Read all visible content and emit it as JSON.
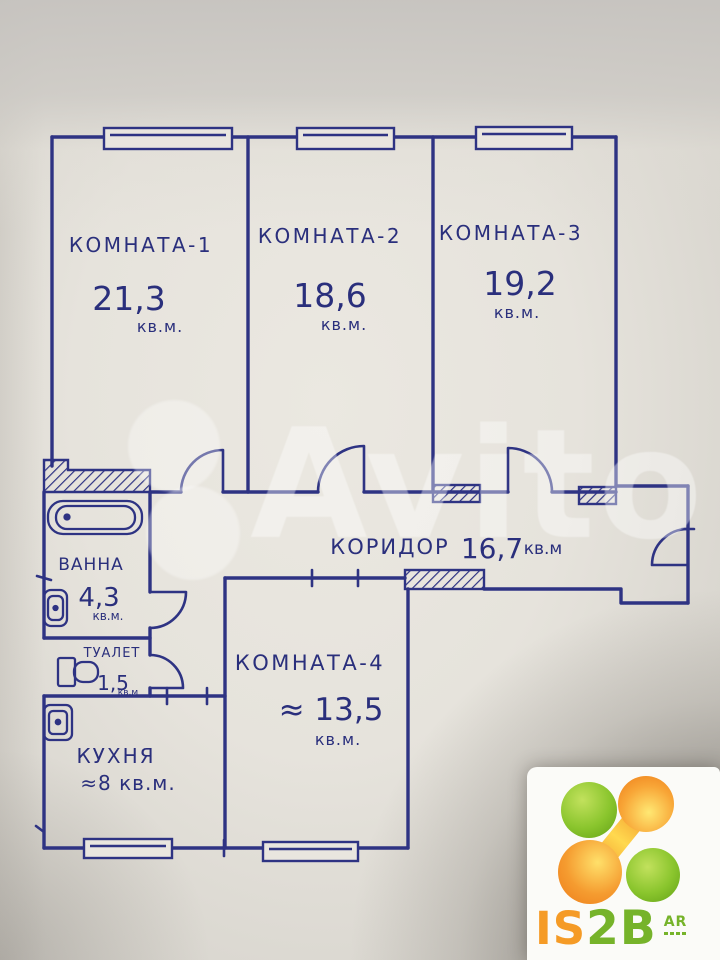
{
  "ink_color": "#2e3383",
  "paper_color": "#e7e4dd",
  "rooms": [
    {
      "name": "КОМНАТА-1",
      "area": "21,3",
      "unit": "кв.м."
    },
    {
      "name": "КОМНАТА-2",
      "area": "18,6",
      "unit": "кв.м."
    },
    {
      "name": "КОМНАТА-3",
      "area": "19,2",
      "unit": "кв.м."
    },
    {
      "name": "КОМНАТА-4",
      "area": "≈ 13,5",
      "unit": "кв.м."
    }
  ],
  "corridor": {
    "name": "КОРИДОР",
    "area": "16,7",
    "unit": "кв.м"
  },
  "bath": {
    "name": "ВАННА",
    "area": "4,3",
    "unit": "кв.м."
  },
  "toilet": {
    "name": "ТУАЛЕТ",
    "area": "1,5",
    "unit": "кв.м"
  },
  "kitchen": {
    "name": "КУХНЯ",
    "area": "≈8 кв.м."
  },
  "watermark": {
    "text": "Avito"
  },
  "logo": {
    "is": "IS",
    "twob": "2B",
    "badge": "AR",
    "green": "#76b32a",
    "orange": "#ef8a1e"
  }
}
